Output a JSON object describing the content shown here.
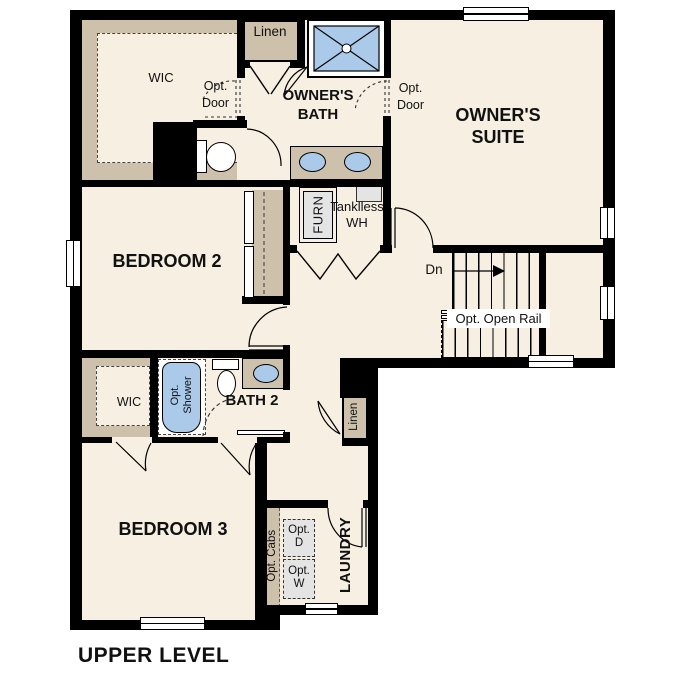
{
  "title": "UPPER LEVEL",
  "palette": {
    "background": "#ffffff",
    "wall": "#000000",
    "floor": "#f6efe2",
    "cabinetry_tan": "#cdc1ab",
    "fixture_blue": "#abc9e9",
    "appliance_gray": "#e4e4e4"
  },
  "rooms": {
    "owners_suite": "OWNER'S SUITE",
    "owners_bath": "OWNER'S BATH",
    "bedroom2": "BEDROOM 2",
    "bedroom3": "BEDROOM 3",
    "bath2": "BATH 2",
    "laundry": "LAUNDRY",
    "wic_owner": "WIC",
    "wic_bed3": "WIC",
    "linen_upper": "Linen",
    "linen_hall": "Linen"
  },
  "annotations": {
    "opt_door_wic": "Opt. Door",
    "opt_door_bath": "Opt. Door",
    "furnace": "FURN",
    "tankless_wh": "Tanklless WH",
    "down": "Dn",
    "opt_open_rail": "Opt. Open Rail",
    "opt_shower": "Opt. Shower",
    "opt_cabs": "Opt. Cabs",
    "opt_dryer": "Opt. D",
    "opt_washer": "Opt. W"
  }
}
